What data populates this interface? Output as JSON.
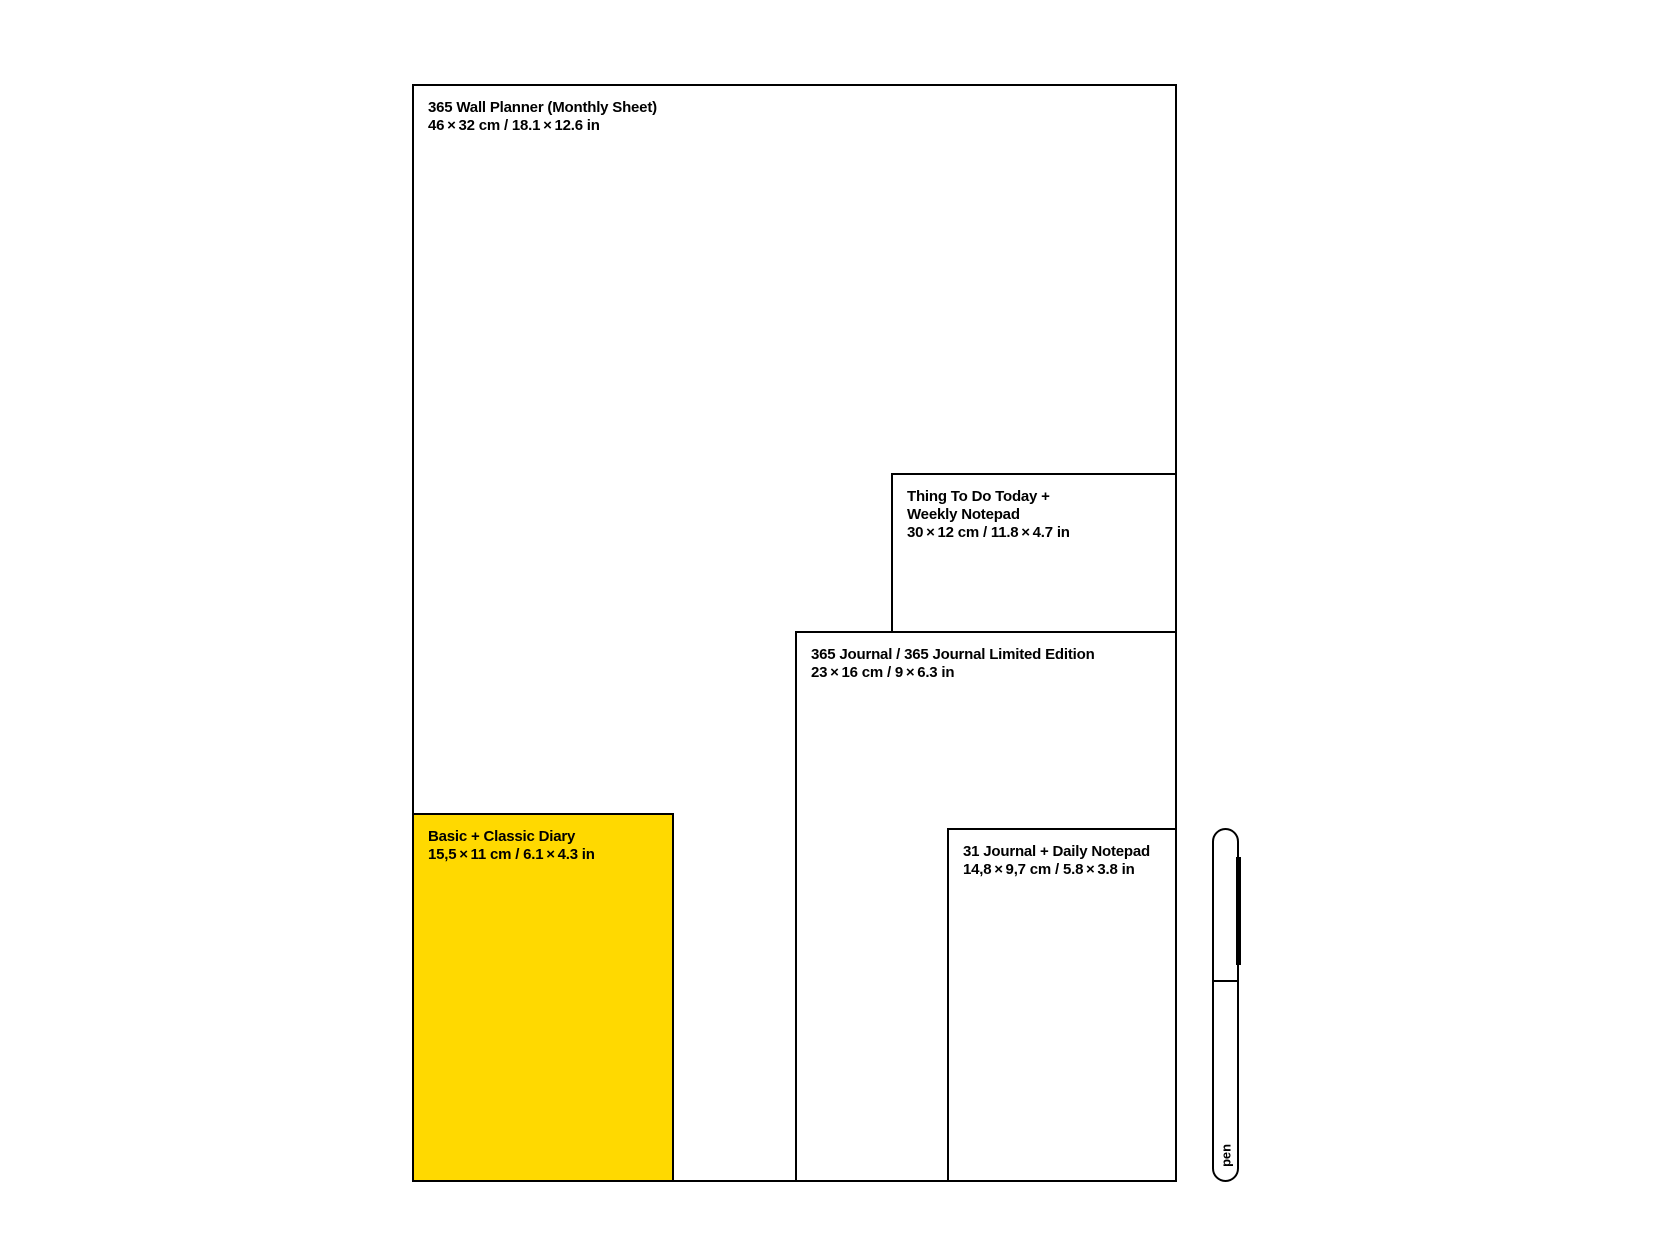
{
  "colors": {
    "background": "#ffffff",
    "outline": "#000000",
    "text": "#000000",
    "diary_fill": "#ffd900",
    "box_fill": "#ffffff"
  },
  "products": {
    "wall_planner": {
      "name": "365 Wall Planner (Monthly Sheet)",
      "size": "46 × 32 cm / 18.1 × 12.6 in"
    },
    "weekly_notepad": {
      "name_lines": [
        "Thing To Do Today +",
        "Weekly Notepad"
      ],
      "size": "30 × 12 cm / 11.8 × 4.7 in"
    },
    "journal_365": {
      "name": "365 Journal / 365 Journal Limited Edition",
      "size": "23 × 16 cm / 9 × 6.3 in"
    },
    "diary": {
      "name": "Basic + Classic Diary",
      "size": "15,5 × 11 cm / 6.1 × 4.3 in"
    },
    "journal_31": {
      "name": "31 Journal + Daily Notepad",
      "size": "14,8 × 9,7 cm / 5.8 × 3.8 in"
    },
    "pen": {
      "label": "pen"
    }
  }
}
